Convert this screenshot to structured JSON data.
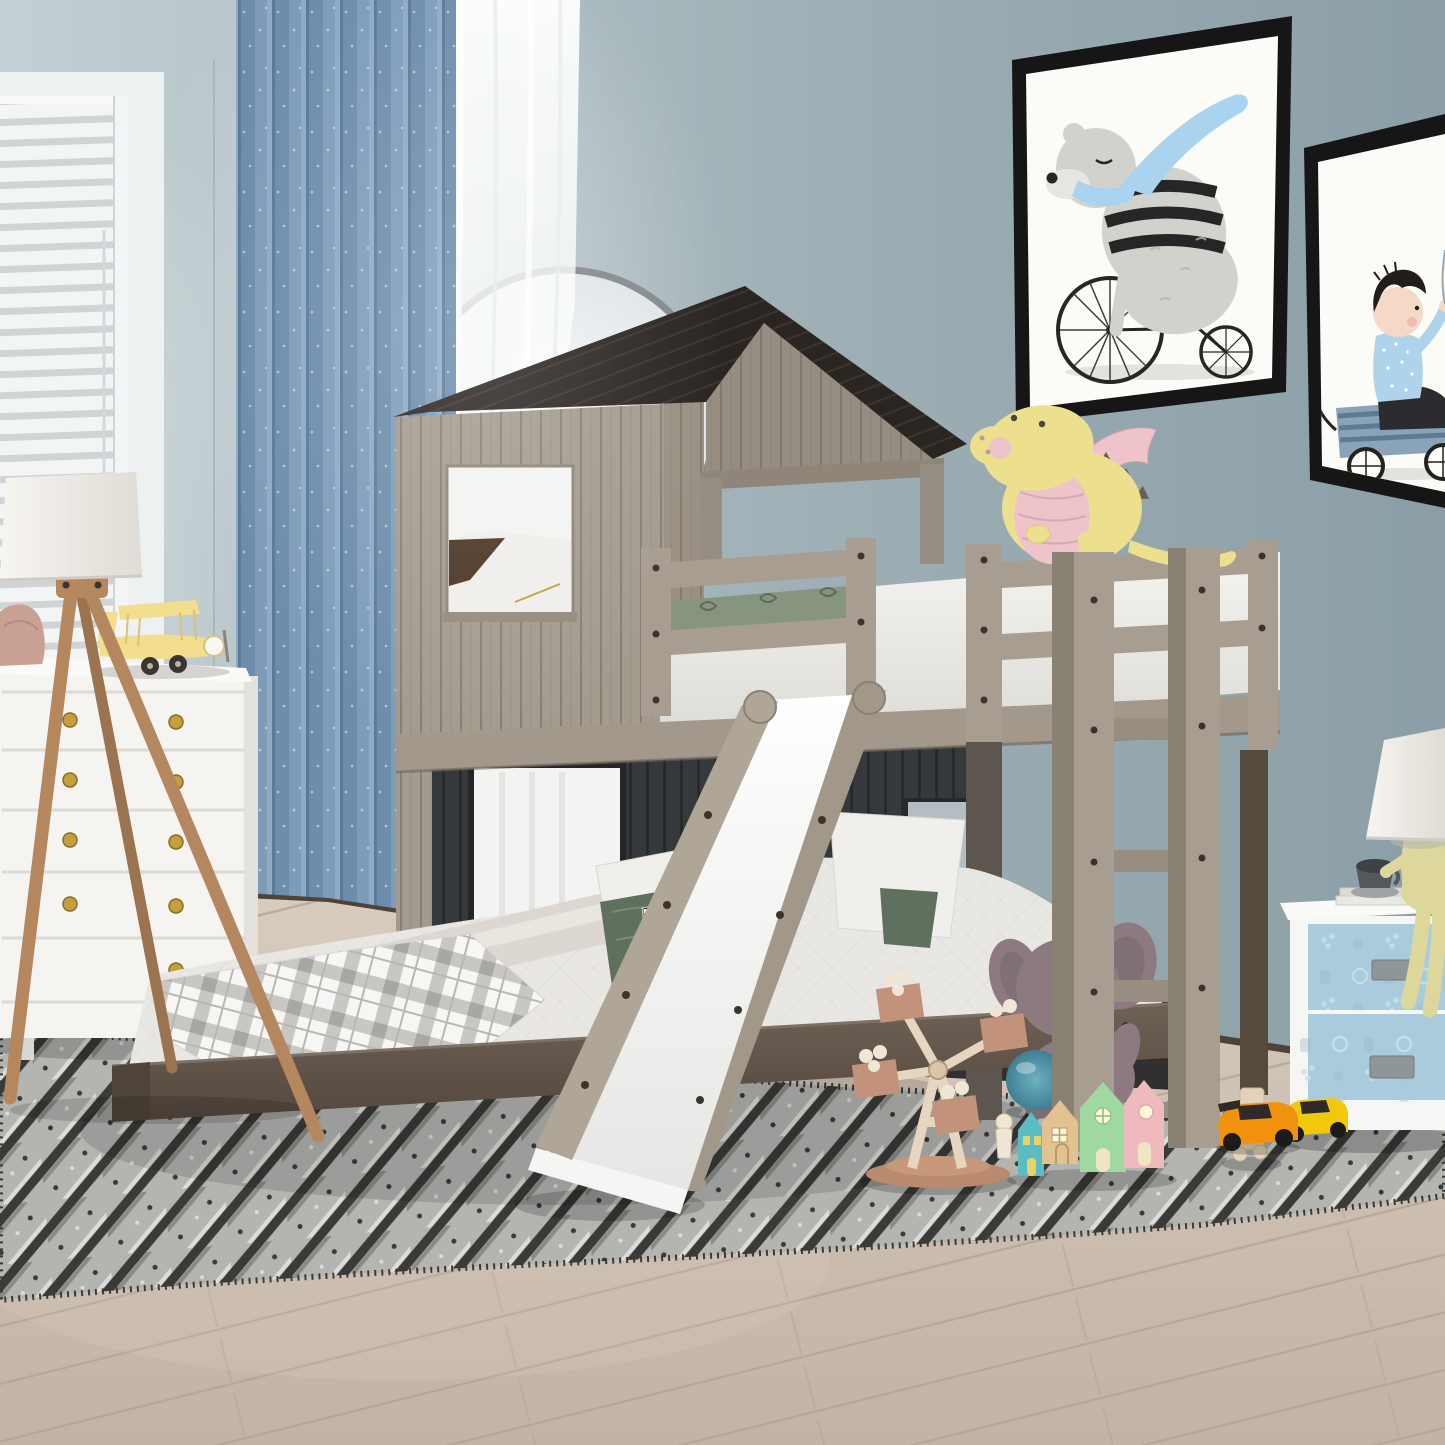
{
  "colors": {
    "wall_a": "#c4d0d3",
    "wall_b": "#9fb0b6",
    "wall_c": "#8b9ea6",
    "trim": "#eef1f2",
    "recess": "#f7f9fa",
    "blind_slat": "#f0f2f3",
    "blind_gap": "#c3c8cc",
    "sill": "#e9eced",
    "arch_rim": "#85898c",
    "curtain_a": "#6d8dac",
    "curtain_b": "#7e9cba",
    "curtain_hi": "#93aec8",
    "curtain_dk": "#5a7a9c",
    "frame_black": "#161616",
    "frame_white": "#fbfbf8",
    "art_gray": "#d2d2cd",
    "art_gray2": "#b5b5b0",
    "art_dark": "#262626",
    "art_scarf": "#a9d3ee",
    "art_muzzle": "#e6e6e1",
    "art_skin": "#f3d9c6",
    "art_hair": "#211e1c",
    "art_shirt": "#aed3ea",
    "art_pants": "#2c2c30",
    "art_wagon": "#8ba3b8",
    "art_wagon_dk": "#5d7a94",
    "art_ground": "#e3e3de",
    "floor_a": "#d8ccbf",
    "floor_b": "#c2b3a4",
    "floor_seam": "#b2a294",
    "baseboard": "#4f4337",
    "rug_base": "#b4b5b1",
    "rug_dark": "#3a3b39",
    "rug_mid": "#8a8b87",
    "rug_light": "#dcdcd8",
    "roof": "#2b2522",
    "roof_line": "#49403a",
    "plank": "#a49b8f",
    "plank_line": "#6e675d",
    "gable": "#968d82",
    "corner": "#9a9184",
    "beam": "#8f8679",
    "panel": "#36393b",
    "panel_line": "#212325",
    "panel_win": "#f3f3f2",
    "panel_win2": "#b9c6cb",
    "underbed": "#232526",
    "rim": "#a2988b",
    "rim_line": "#6f665c",
    "matt_a": "#f4f3f0",
    "matt_b": "#dddbd6",
    "bed_green": "#87947f",
    "bed_green_dk": "#5c6c57",
    "rail": "#a79d90",
    "rail_side": "#8a8175",
    "rail_dark": "#5d564e",
    "screw": "#3b342d",
    "rung": "#978d80",
    "dragon": "#ece08e",
    "dragon_pink": "#eec4ca",
    "dragon_cheek": "#ecc3cb",
    "dragon_dk": "#6b5f52",
    "dragon_eye": "#4a4338",
    "bedding": "#e9e7e3",
    "quilt": "#d3d0ca",
    "bolster": "#dcd8d1",
    "bolster_hi": "#e9e6e0",
    "plaid_bg": "#f7f6f4",
    "plaid_band": "#c9c7c3",
    "plaid_dk": "#a9a7a3",
    "plaid_line": "#b9b7b3",
    "pillow_white": "#f1efeb",
    "pillow_green": "#5f705e",
    "hound_dark": "#23211f",
    "hound_bg": "#f2f1ee",
    "bedframe_a": "#6e6156",
    "bedframe_b": "#54483e",
    "bedframe_end": "#4e443b",
    "slide_rail": "#b0a698",
    "slide_rail2": "#a2988a",
    "slide_a": "#ffffff",
    "slide_b": "#e6e6e4",
    "dresser": "#f5f4f1",
    "dresser_top": "#fbfaf8",
    "dresser_side": "#e4e2dd",
    "dresser_line": "#dcdad4",
    "dresser_leg": "#d9d7d1",
    "knob": "#c59f3e",
    "plane": "#f3dd8e",
    "plane_line": "#d9c27a",
    "plane_dark": "#3c3631",
    "bag": "#c9a193",
    "lamp_wood": "#b4875e",
    "lamp_wood_dk": "#9b7350",
    "shade_a": "#f7f5f1",
    "shade_b": "#dfdcd5",
    "shade_rim": "#cfccc5",
    "ns_white": "#f6f6f4",
    "ns_top": "#fafaf8",
    "ns_drawer": "#a9cbdc",
    "ns_hi": "#c6e0ea",
    "ns_dk": "#8fb6ca",
    "ns_handle": "#8f9699",
    "fig": "#ddd79b",
    "cup_dark": "#3e4146",
    "cup": "#54575c",
    "saucer": "#9fa2a6",
    "book": "#e8e8e4",
    "book2": "#dddad4",
    "post_dark": "#564a3e",
    "elephant": "#8d7a80",
    "elephant_in": "#776770",
    "elephant_lt": "#998790",
    "elephant_eye": "#1c1a1b",
    "trunk": "#857279",
    "ball_a": "#6fb0bf",
    "ball_b": "#3f7f94",
    "house_teal": "#5bbcc4",
    "house_tan": "#e3c291",
    "house_green": "#9fd9a0",
    "house_pink": "#f0b9bd",
    "house_win": "#e8d36a",
    "house_pane": "#fdf6d8",
    "house_door": "#efe5c2",
    "toy_wood": "#e6d6bf",
    "toy_wood_dk": "#c2937a",
    "toy_base": "#b98a6d",
    "toy_hub": "#d9c6ab",
    "peg": "#efe6d6",
    "peg_line": "#d9c9ad",
    "car_orange": "#f0920e",
    "car_yellow": "#f2c80c",
    "car_dark": "#2e2b26",
    "wheel": "#1d1b19",
    "robot": "#e3d3ba",
    "robot_line": "#c9b696",
    "white": "#ffffff"
  },
  "scene": {
    "room": {
      "wall": "blue-gray wall",
      "window": "white blinds window",
      "blue_curtain": "speckled blue curtain",
      "sheer_curtain": "white sheer curtain",
      "arch_mirror": "arched mirror",
      "floor": "light wood plank floor",
      "rug": "gray patterned rug",
      "baseboard": "dark baseboard"
    },
    "wall_art": {
      "left": "bear with blue scarf riding penny-farthing bicycle",
      "right": "boy riding in blue wagon"
    },
    "furniture": {
      "dresser": "white dresser with gold knobs",
      "floor_lamp": "wooden tripod floor lamp with white shade",
      "nightstand": "white nightstand with blue embossed drawers",
      "figure_lamp": "yellow seated-figure table lamp with white shade",
      "loft_bed": "rustic gray playhouse loft bunk bed with dark roof, ladder and slide",
      "lower_bed": "full-size lower bed with white bedding and plaid throw"
    },
    "toys": {
      "dragon_plush": "yellow and pink dragon plush on top bunk",
      "elephant_plush": "mauve elephant plush",
      "ball": "teal ball",
      "wooden_windmill": "wooden windmill toy",
      "wooden_houses": "teal, tan, green and pink wooden houses",
      "peg_doll": "wooden peg doll",
      "robot": "wooden block robot",
      "toy_cars": "orange and yellow toy cars",
      "biplane": "yellow toy biplane on dresser",
      "bag": "pink pouch on dresser"
    }
  }
}
